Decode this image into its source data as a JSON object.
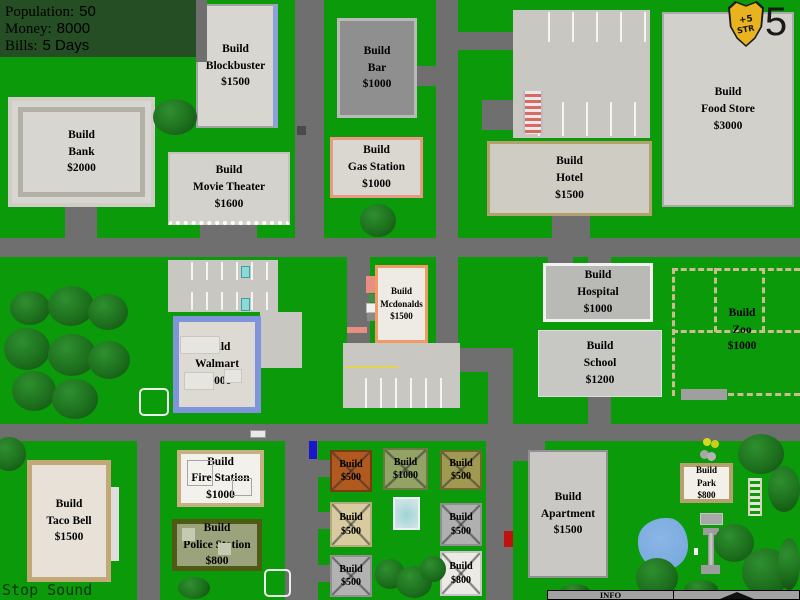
{
  "hud": {
    "rows": [
      {
        "label": "Population:",
        "value": "50"
      },
      {
        "label": "Money:",
        "value": "8000"
      },
      {
        "label": "Bills:",
        "value": "5 Days"
      }
    ]
  },
  "badge": {
    "icon": "shield-icon",
    "bonus": "+5",
    "stat": "STR",
    "count": "5"
  },
  "sites": {
    "blockbuster": {
      "action": "Build",
      "name": "Blockbuster",
      "price": "$1500"
    },
    "bar": {
      "action": "Build",
      "name": "Bar",
      "price": "$1000"
    },
    "food_store": {
      "action": "Build",
      "name": "Food Store",
      "price": "$3000"
    },
    "bank": {
      "action": "Build",
      "name": "Bank",
      "price": "$2000"
    },
    "gas_station": {
      "action": "Build",
      "name": "Gas Station",
      "price": "$1000"
    },
    "hotel": {
      "action": "Build",
      "name": "Hotel",
      "price": "$1500"
    },
    "movie_theater": {
      "action": "Build",
      "name": "Movie Theater",
      "price": "$1600"
    },
    "mcdonalds": {
      "action": "Build",
      "name": "Mcdonalds",
      "price": "$1500"
    },
    "hospital": {
      "action": "Build",
      "name": "Hospital",
      "price": "$1000"
    },
    "school": {
      "action": "Build",
      "name": "School",
      "price": "$1200"
    },
    "zoo": {
      "action": "Build",
      "name": "Zoo",
      "price": "$1000"
    },
    "walmart": {
      "action": "Build",
      "name": "Walmart",
      "price": "$2000"
    },
    "fire_station": {
      "action": "Build",
      "name": "Fire Station",
      "price": "$1000"
    },
    "police_station": {
      "action": "Build",
      "name": "Police Station",
      "price": "$800"
    },
    "taco_bell": {
      "action": "Build",
      "name": "Taco Bell",
      "price": "$1500"
    },
    "apartment": {
      "action": "Build",
      "name": "Apartment",
      "price": "$1500"
    },
    "park": {
      "action": "Build",
      "name": "Park",
      "price": "$800"
    }
  },
  "lots": {
    "lot1": {
      "action": "Build",
      "price": "$500"
    },
    "lot2": {
      "action": "Build",
      "price": "$1000"
    },
    "lot3": {
      "action": "Build",
      "price": "$500"
    },
    "lot4": {
      "action": "Build",
      "price": "$500"
    },
    "lot5": {
      "action": "Build",
      "price": "$500"
    },
    "lot6": {
      "action": "Build",
      "price": "$500"
    },
    "lot7": {
      "action": "Build",
      "price": "$800"
    }
  },
  "controls": {
    "stop_sound": "Stop Sound",
    "info": "INFO",
    "info_toggle_icon": "chevron-up-icon"
  },
  "colors": {
    "grass": "#0a9a0a",
    "road": "#6f6f6f",
    "hud_bg": "#254e25",
    "shield_gold": "#e8b31e",
    "water": "#7aaade",
    "zoo_fence": "#cabd92"
  }
}
